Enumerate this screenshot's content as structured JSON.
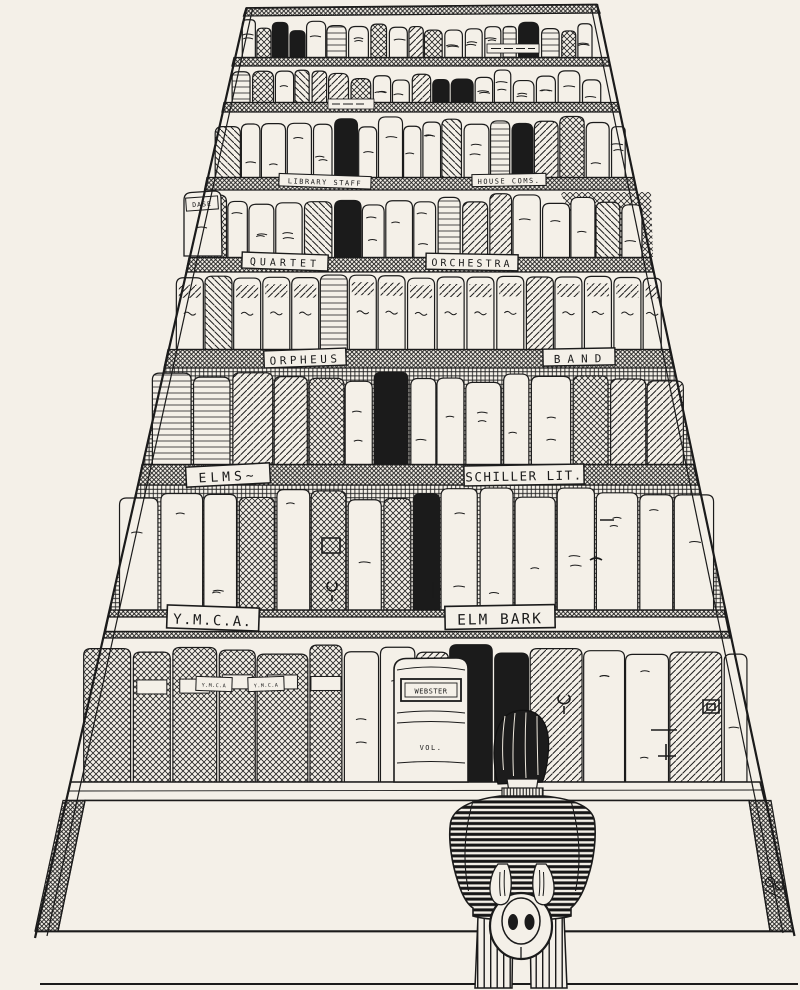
{
  "artwork": {
    "description": "Pen-and-ink cartoon of a man holding his hat behind his back while gazing up at a towering bookcase of labeled shelves",
    "paper_color": "#f4f0e8",
    "ink_color": "#1b1b1b"
  },
  "shelf_labels": {
    "library_staff": "LIBRARY STAFF",
    "house_coms": "HOUSE COMS.",
    "quartet": "QUARTET",
    "orchestra": "ORCHESTRA",
    "orpheus": "ORPHEUS",
    "band": "BAND",
    "elms": "ELMS~",
    "schiller_lit": "SCHILLER LIT.",
    "ymca": "Y.M.C.A.",
    "elm_bark": "ELM BARK"
  },
  "book_spines": {
    "dase": "DASE",
    "webster": "WEBSTER",
    "webster_vol": "VOL.",
    "ymca_spine_a": "Y.M.C.A",
    "ymca_spine_b": "Y.M.C.A"
  }
}
